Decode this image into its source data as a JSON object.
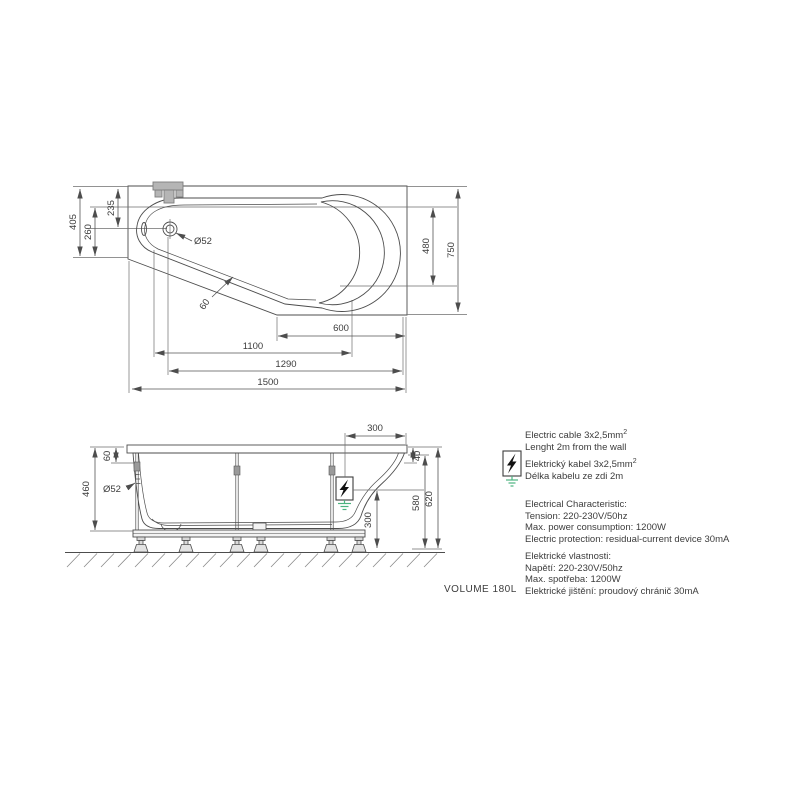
{
  "drawing": {
    "volume_label": "VOLUME 180L",
    "top_view": {
      "dim_405": "405",
      "dim_260": "260",
      "dim_235": "235",
      "dim_drain": "Ø52",
      "dim_rim_offset": "60",
      "dim_480": "480",
      "dim_750": "750",
      "dim_600": "600",
      "dim_1100": "1100",
      "dim_1290": "1290",
      "dim_1500": "1500"
    },
    "side_view": {
      "dim_460": "460",
      "dim_60": "60",
      "dim_drain": "Ø52",
      "dim_300_top": "300",
      "dim_40": "40",
      "dim_580": "580",
      "dim_620": "620",
      "dim_300_bottom": "300"
    },
    "notes": {
      "cable_en_line1": "Electric cable 3x2,5mm",
      "cable_sup": "2",
      "cable_en_line2": "Lenght 2m from the wall",
      "cable_cz_line1": "Elektrický kabel 3x2,5mm",
      "cable_cz_line2": "Délka kabelu ze zdi 2m",
      "electrical_en": {
        "title": "Electrical Characteristic:",
        "line1": "Tension: 220-230V/50hz",
        "line2": "Max. power consumption: 1200W",
        "line3": "Electric protection: residual-current device 30mA"
      },
      "electrical_cz": {
        "title": "Elektrické vlastnosti:",
        "line1": "Napětí: 220-230V/50hz",
        "line2": "Max. spotřeba: 1200W",
        "line3": "Elektrické jištění: proudový chránič 30mA"
      }
    },
    "colors": {
      "tub_fill": "#e9e9e9",
      "line": "#4d4d4d",
      "fixture_fill": "#b5b5b5",
      "ground_green": "#4db380",
      "text": "#3c3c3c"
    }
  }
}
